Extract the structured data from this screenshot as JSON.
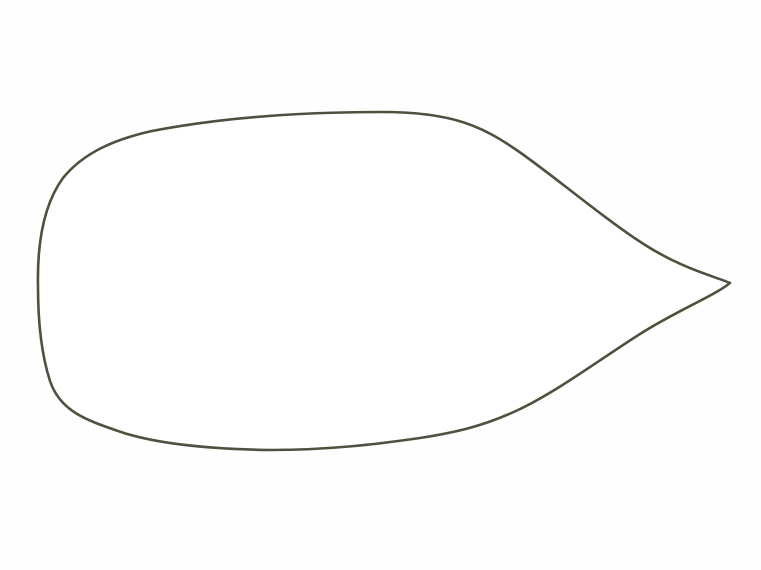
{
  "figure": {
    "type": "yacht-interior-deck-plan",
    "orientation": "bow-right",
    "description": "Top-down interior layout plan of a sailing yacht: rounded transom at left, cockpit with wheel, companionway steps down to a salon with yellow U-shaped settee and table, galley and head to starboard, and a green V-berth forward cabin at the pointed bow on the right.",
    "regions": [
      "transom",
      "cockpit",
      "cockpit-bench",
      "steering-wheel",
      "companionway-steps",
      "galley",
      "stove",
      "round-sink",
      "double-sink",
      "burner-unit",
      "basin",
      "salon",
      "u-shaped-settee",
      "salon-table",
      "aft-bench-seat",
      "head-toilet-room",
      "toilet",
      "forward-cabin",
      "v-berth-cushion",
      "chart-seat",
      "storage-lockers",
      "vented-locker"
    ]
  },
  "colors": {
    "background": "#fffdfe",
    "hull_outline": "#4d523f",
    "line_gray": "#8791a0",
    "line_dark": "#3c4350",
    "floor_blue": "#dde3ee",
    "berth_green": "#a0c351",
    "settee_yellow": "#efd02e",
    "settee_outline": "#6f6b3a",
    "table_fill": "#f4f4f2",
    "steps_fill": "#b3bac6",
    "steps_slat": "#4e5665",
    "wheel_teal": "#2c6157",
    "cockpit_outline": "#6c7245",
    "smudge": "#9aa3ae"
  }
}
